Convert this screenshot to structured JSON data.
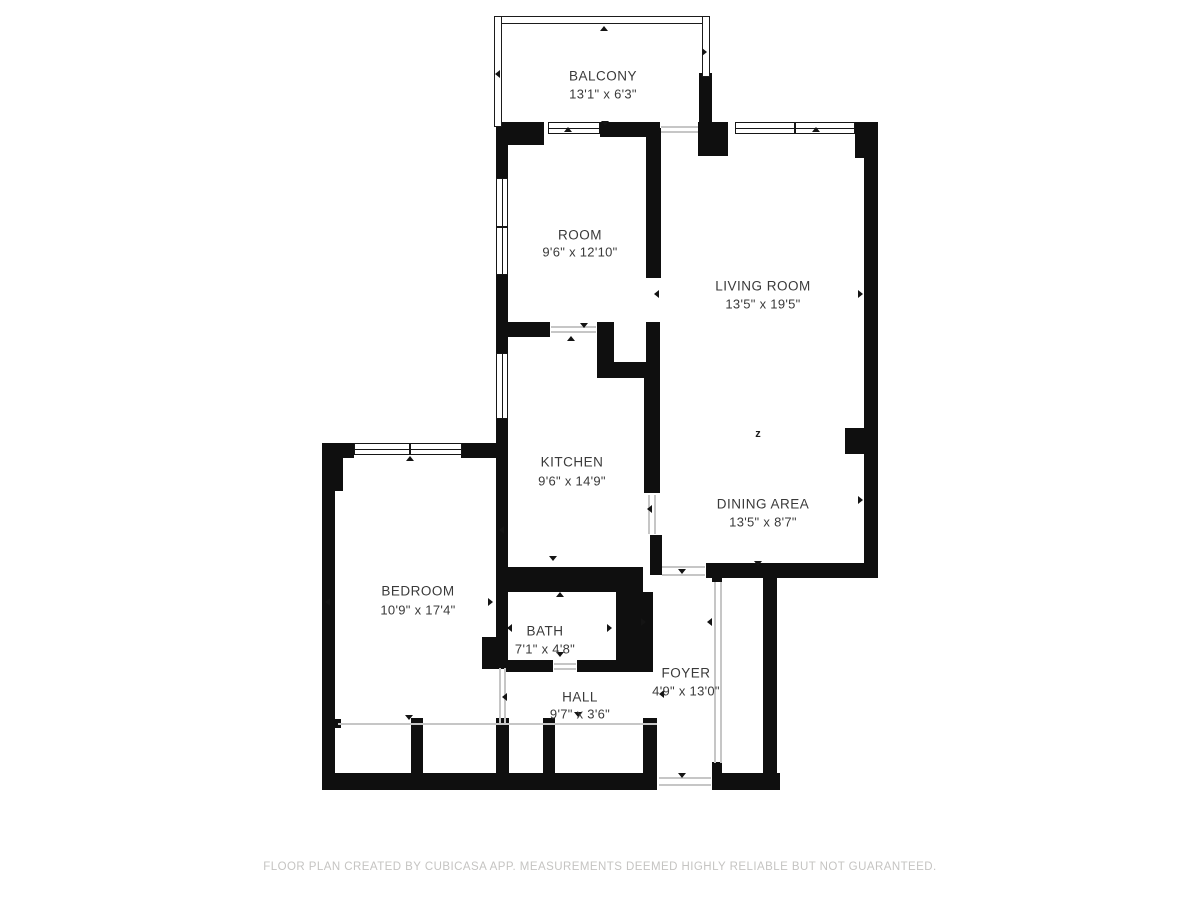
{
  "plan": {
    "wall_color": "#0f0f0f",
    "thin_line_color": "#c6c6c6",
    "label_color": "#3a3a3a",
    "footer": {
      "text": "FLOOR PLAN CREATED BY CUBICASA APP. MEASUREMENTS DEEMED HIGHLY RELIABLE BUT NOT GUARANTEED.",
      "color": "#c5c4c2"
    },
    "rooms": [
      {
        "name": "BALCONY",
        "dims": "13'1\" x 6'3\"",
        "cx": 603,
        "name_y": 76,
        "dims_y": 94
      },
      {
        "name": "ROOM",
        "dims": "9'6\" x 12'10\"",
        "cx": 580,
        "name_y": 235,
        "dims_y": 252
      },
      {
        "name": "LIVING ROOM",
        "dims": "13'5\" x 19'5\"",
        "cx": 763,
        "name_y": 286,
        "dims_y": 304
      },
      {
        "name": "KITCHEN",
        "dims": "9'6\" x 14'9\"",
        "cx": 572,
        "name_y": 462,
        "dims_y": 481
      },
      {
        "name": "DINING AREA",
        "dims": "13'5\" x 8'7\"",
        "cx": 763,
        "name_y": 504,
        "dims_y": 522
      },
      {
        "name": "BEDROOM",
        "dims": "10'9\" x 17'4\"",
        "cx": 418,
        "name_y": 591,
        "dims_y": 610
      },
      {
        "name": "BATH",
        "dims": "7'1\" x 4'8\"",
        "cx": 545,
        "name_y": 631,
        "dims_y": 649
      },
      {
        "name": "HALL",
        "dims": "9'7\" x 3'6\"",
        "cx": 580,
        "name_y": 697,
        "dims_y": 714
      },
      {
        "name": "FOYER",
        "dims": "4'9\" x 13'0\"",
        "cx": 686,
        "name_y": 673,
        "dims_y": 691
      }
    ],
    "walls": [
      [
        496,
        122,
        48,
        23
      ],
      [
        496,
        122,
        12,
        58
      ],
      [
        600,
        122,
        60,
        15
      ],
      [
        698,
        122,
        30,
        34
      ],
      [
        855,
        122,
        23,
        36
      ],
      [
        864,
        122,
        14,
        456
      ],
      [
        845,
        428,
        20,
        26
      ],
      [
        699,
        73,
        13,
        52
      ],
      [
        496,
        275,
        12,
        78
      ],
      [
        496,
        419,
        12,
        249
      ],
      [
        504,
        322,
        46,
        15
      ],
      [
        597,
        322,
        17,
        56
      ],
      [
        597,
        362,
        63,
        16
      ],
      [
        646,
        128,
        15,
        150
      ],
      [
        646,
        322,
        14,
        42
      ],
      [
        644,
        378,
        16,
        115
      ],
      [
        650,
        535,
        12,
        40
      ],
      [
        706,
        563,
        172,
        15
      ],
      [
        496,
        567,
        147,
        25
      ],
      [
        616,
        592,
        37,
        74
      ],
      [
        504,
        660,
        49,
        12
      ],
      [
        577,
        660,
        76,
        12
      ],
      [
        482,
        637,
        26,
        32
      ],
      [
        322,
        443,
        32,
        15
      ],
      [
        461,
        443,
        47,
        15
      ],
      [
        322,
        443,
        13,
        347
      ],
      [
        322,
        455,
        21,
        36
      ],
      [
        322,
        773,
        335,
        17
      ],
      [
        712,
        773,
        68,
        17
      ],
      [
        763,
        567,
        14,
        223
      ],
      [
        411,
        718,
        12,
        57
      ],
      [
        496,
        718,
        13,
        57
      ],
      [
        543,
        718,
        12,
        57
      ],
      [
        643,
        718,
        14,
        57
      ],
      [
        712,
        568,
        10,
        14
      ],
      [
        712,
        762,
        10,
        13
      ],
      [
        333,
        719,
        8,
        9
      ]
    ],
    "windows": [
      {
        "x": 496,
        "y": 178,
        "w": 12,
        "h": 97,
        "mullions": [
          47
        ]
      },
      {
        "x": 496,
        "y": 353,
        "w": 12,
        "h": 66,
        "mullions": []
      },
      {
        "x": 548,
        "y": 122,
        "w": 52,
        "h": 12,
        "mullions": []
      },
      {
        "x": 735,
        "y": 122,
        "w": 120,
        "h": 12,
        "mullions": [
          58
        ]
      },
      {
        "x": 354,
        "y": 443,
        "w": 108,
        "h": 12,
        "mullions": [
          54
        ]
      }
    ],
    "railings": [
      [
        494,
        16,
        216,
        8
      ],
      [
        494,
        16,
        8,
        111
      ],
      [
        702,
        16,
        8,
        61
      ]
    ],
    "thin_lines": [
      [
        338,
        723,
        319,
        2
      ],
      [
        499,
        668,
        2,
        55
      ],
      [
        504,
        668,
        2,
        55
      ],
      [
        714,
        582,
        2,
        181
      ],
      [
        720,
        582,
        2,
        181
      ],
      [
        661,
        126,
        37,
        2
      ],
      [
        661,
        131,
        37,
        2
      ],
      [
        551,
        326,
        45,
        2
      ],
      [
        551,
        331,
        45,
        2
      ],
      [
        648,
        495,
        2,
        39
      ],
      [
        654,
        495,
        2,
        39
      ],
      [
        662,
        566,
        43,
        2
      ],
      [
        662,
        574,
        43,
        2
      ],
      [
        554,
        663,
        22,
        2
      ],
      [
        554,
        668,
        22,
        2
      ],
      [
        659,
        777,
        52,
        2
      ],
      [
        659,
        784,
        52,
        2
      ]
    ],
    "arrows": [
      {
        "x": 604,
        "y": 30,
        "dir": "up"
      },
      {
        "x": 499,
        "y": 74,
        "dir": "left"
      },
      {
        "x": 706,
        "y": 52,
        "dir": "right"
      },
      {
        "x": 568,
        "y": 131,
        "dir": "up"
      },
      {
        "x": 605,
        "y": 125,
        "dir": "down"
      },
      {
        "x": 584,
        "y": 327,
        "dir": "down"
      },
      {
        "x": 571,
        "y": 340,
        "dir": "up"
      },
      {
        "x": 816,
        "y": 131,
        "dir": "up"
      },
      {
        "x": 658,
        "y": 294,
        "dir": "left"
      },
      {
        "x": 862,
        "y": 294,
        "dir": "right"
      },
      {
        "x": 862,
        "y": 500,
        "dir": "right"
      },
      {
        "x": 758,
        "y": 565,
        "dir": "down"
      },
      {
        "x": 651,
        "y": 509,
        "dir": "left"
      },
      {
        "x": 553,
        "y": 560,
        "dir": "down"
      },
      {
        "x": 503,
        "y": 530,
        "dir": "left"
      },
      {
        "x": 329,
        "y": 602,
        "dir": "left"
      },
      {
        "x": 492,
        "y": 602,
        "dir": "right"
      },
      {
        "x": 409,
        "y": 719,
        "dir": "down"
      },
      {
        "x": 410,
        "y": 460,
        "dir": "up"
      },
      {
        "x": 511,
        "y": 628,
        "dir": "left"
      },
      {
        "x": 611,
        "y": 628,
        "dir": "right"
      },
      {
        "x": 560,
        "y": 596,
        "dir": "up"
      },
      {
        "x": 560,
        "y": 656,
        "dir": "down"
      },
      {
        "x": 506,
        "y": 697,
        "dir": "left"
      },
      {
        "x": 578,
        "y": 716,
        "dir": "down"
      },
      {
        "x": 682,
        "y": 573,
        "dir": "down"
      },
      {
        "x": 645,
        "y": 622,
        "dir": "right"
      },
      {
        "x": 711,
        "y": 622,
        "dir": "left"
      },
      {
        "x": 663,
        "y": 694,
        "dir": "left"
      },
      {
        "x": 682,
        "y": 777,
        "dir": "down"
      }
    ],
    "symbols": [
      {
        "label": "z",
        "x": 758,
        "y": 434
      }
    ]
  }
}
